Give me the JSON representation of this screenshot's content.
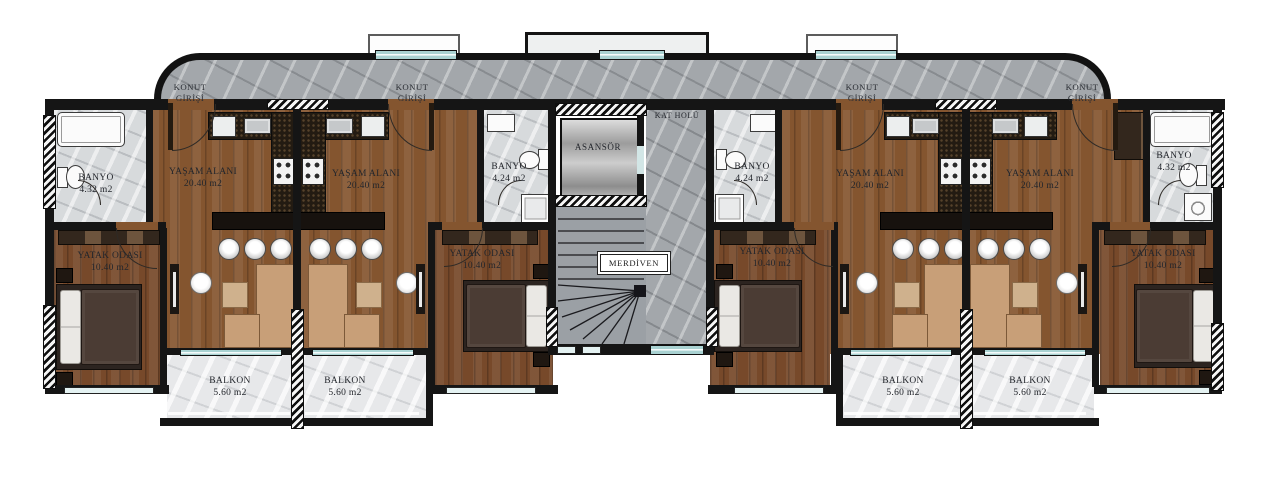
{
  "plan": {
    "entrance_label": "KONUT\nGİRİŞİ",
    "core": {
      "hall": "KAT HOLÜ",
      "elevator": "ASANSÖR",
      "stairs": "MERDİVEN"
    },
    "apartments": [
      {
        "living": {
          "name": "YAŞAM ALANI",
          "area": "20.40 m2"
        },
        "bathroom": {
          "name": "BANYO",
          "area": "4.32 m2"
        },
        "bedroom": {
          "name": "YATAK ODASI",
          "area": "10.40 m2"
        },
        "balcony": {
          "name": "BALKON",
          "area": "5.60 m2"
        }
      },
      {
        "living": {
          "name": "YAŞAM ALANI",
          "area": "20.40 m2"
        },
        "bathroom": {
          "name": "BANYO",
          "area": "4.24 m2"
        },
        "bedroom": {
          "name": "YATAK ODASI",
          "area": "10.40 m2"
        },
        "balcony": {
          "name": "BALKON",
          "area": "5.60 m2"
        }
      },
      {
        "living": {
          "name": "YAŞAM ALANI",
          "area": "20.40 m2"
        },
        "bathroom": {
          "name": "BANYO",
          "area": "4.24 m2"
        },
        "bedroom": {
          "name": "YATAK ODASI",
          "area": "10.40 m2"
        },
        "balcony": {
          "name": "BALKON",
          "area": "5.60 m2"
        }
      },
      {
        "living": {
          "name": "YAŞAM ALANI",
          "area": "20.40 m2"
        },
        "bathroom": {
          "name": "BANYO",
          "area": "4.32 m2"
        },
        "bedroom": {
          "name": "YATAK ODASI",
          "area": "10.40 m2"
        },
        "balcony": {
          "name": "BALKON",
          "area": "5.60 m2"
        }
      }
    ],
    "colors": {
      "wall": "#151515",
      "wood": "#84552f",
      "corridor_marble": "#a3a7ab",
      "bath_marble": "#d7dadc",
      "window_glass": "#a9d2d2",
      "kitchen_granite": "#231b12"
    }
  }
}
